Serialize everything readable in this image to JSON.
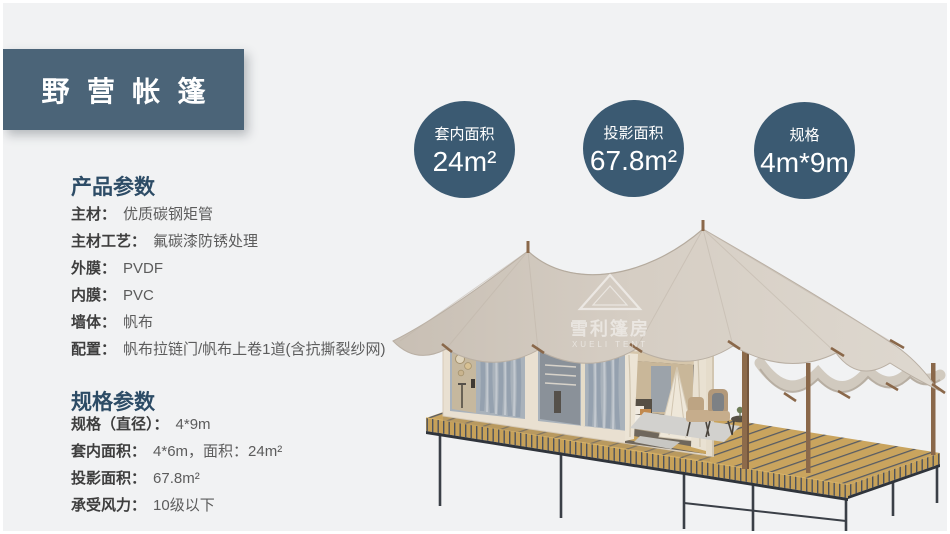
{
  "page": {
    "background": "#f1f2f3",
    "panel_color": "#4b6478",
    "circle_color": "#3b5a72"
  },
  "header": {
    "title": "野营帐篷"
  },
  "stats": [
    {
      "label": "套内面积",
      "value": "24m²"
    },
    {
      "label": "投影面积",
      "value": "67.8m²"
    },
    {
      "label": "规格",
      "value": "4m*9m"
    }
  ],
  "product_params": {
    "heading": "产品参数",
    "items": [
      {
        "label": "主材：",
        "value": "优质碳钢矩管"
      },
      {
        "label": "主材工艺：",
        "value": "氟碳漆防锈处理"
      },
      {
        "label": "外膜：",
        "value": "PVDF"
      },
      {
        "label": "内膜：",
        "value": "PVC"
      },
      {
        "label": "墙体：",
        "value": "帆布"
      },
      {
        "label": "配置：",
        "value": "帆布拉链门/帆布上卷1道(含抗撕裂纱网)"
      }
    ]
  },
  "spec_params": {
    "heading": "规格参数",
    "items": [
      {
        "label": "规格（直径）：",
        "value": "4*9m"
      },
      {
        "label": "套内面积：",
        "value": "4*6m，面积：24m²"
      },
      {
        "label": "投影面积：",
        "value": "67.8m²"
      },
      {
        "label": "承受风力：",
        "value": "10级以下"
      }
    ]
  },
  "tent": {
    "watermark_cn": "雪利篷房",
    "watermark_en": "XUELI TENT"
  }
}
